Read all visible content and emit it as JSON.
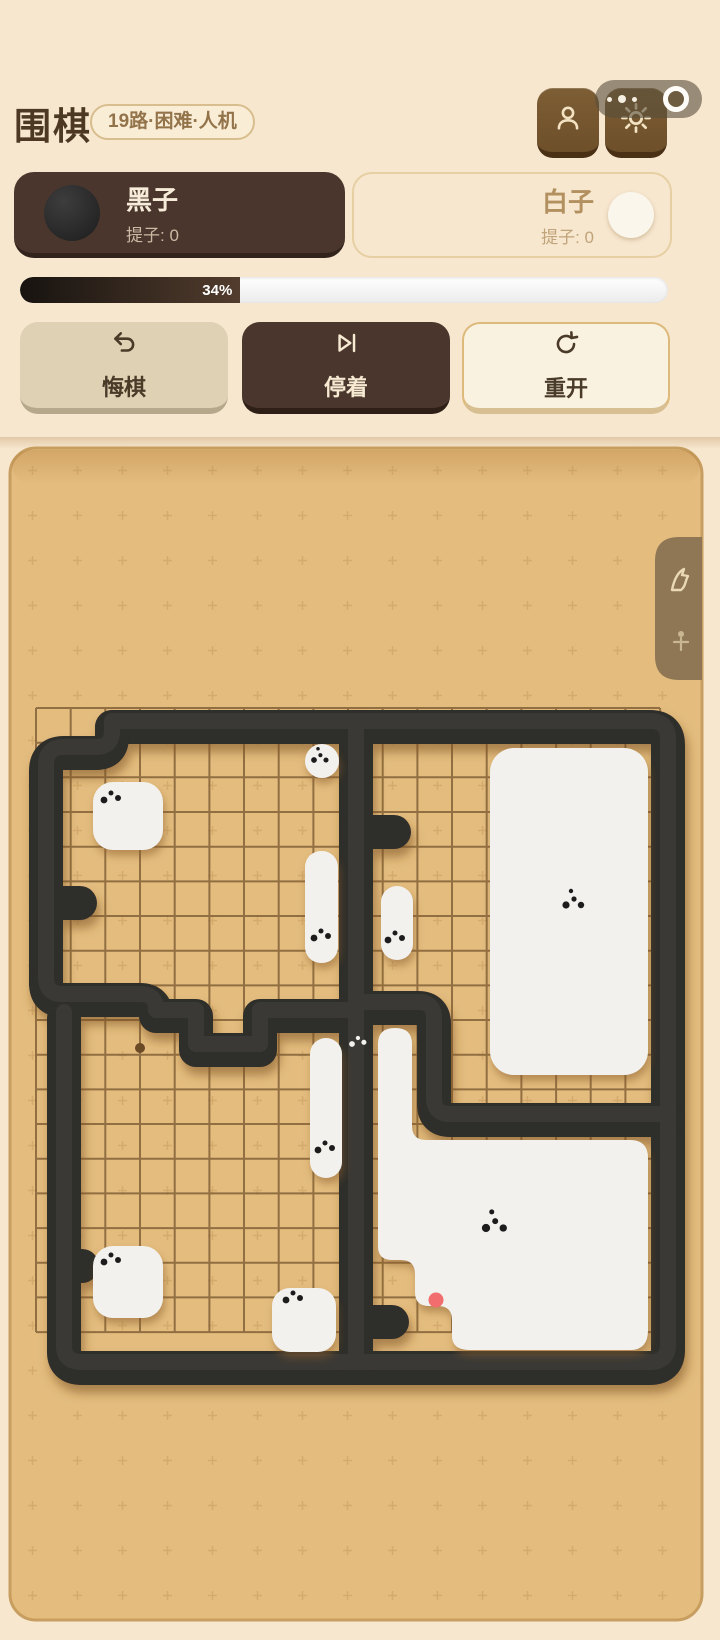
{
  "header": {
    "title": "围棋",
    "badge": "19路·困难·人机"
  },
  "players": {
    "black": {
      "name": "黑子",
      "captures": "提子: 0"
    },
    "white": {
      "name": "白子",
      "captures": "提子: 0"
    }
  },
  "progress": {
    "percent": 34,
    "label": "34%"
  },
  "actions": {
    "undo": "悔棋",
    "pass": "停着",
    "restart": "重开"
  },
  "board": {
    "lines": 19,
    "last_move_marker_color": "#f26d6d",
    "visible_star_points": 1,
    "white_group_count": 9
  },
  "colors": {
    "page_bg": "#f7e7cf",
    "panel_bg": "#e3bc7e",
    "panel_border": "#c79e5f",
    "wall": "#2f2d2b",
    "white_group": "#f2f1ee",
    "grid_line": "#7b5a31",
    "dark_brown": "#4a362c",
    "button_brown": "#7d5e35",
    "last_move": "#f26d6d",
    "side_tab": "#8a7354"
  }
}
